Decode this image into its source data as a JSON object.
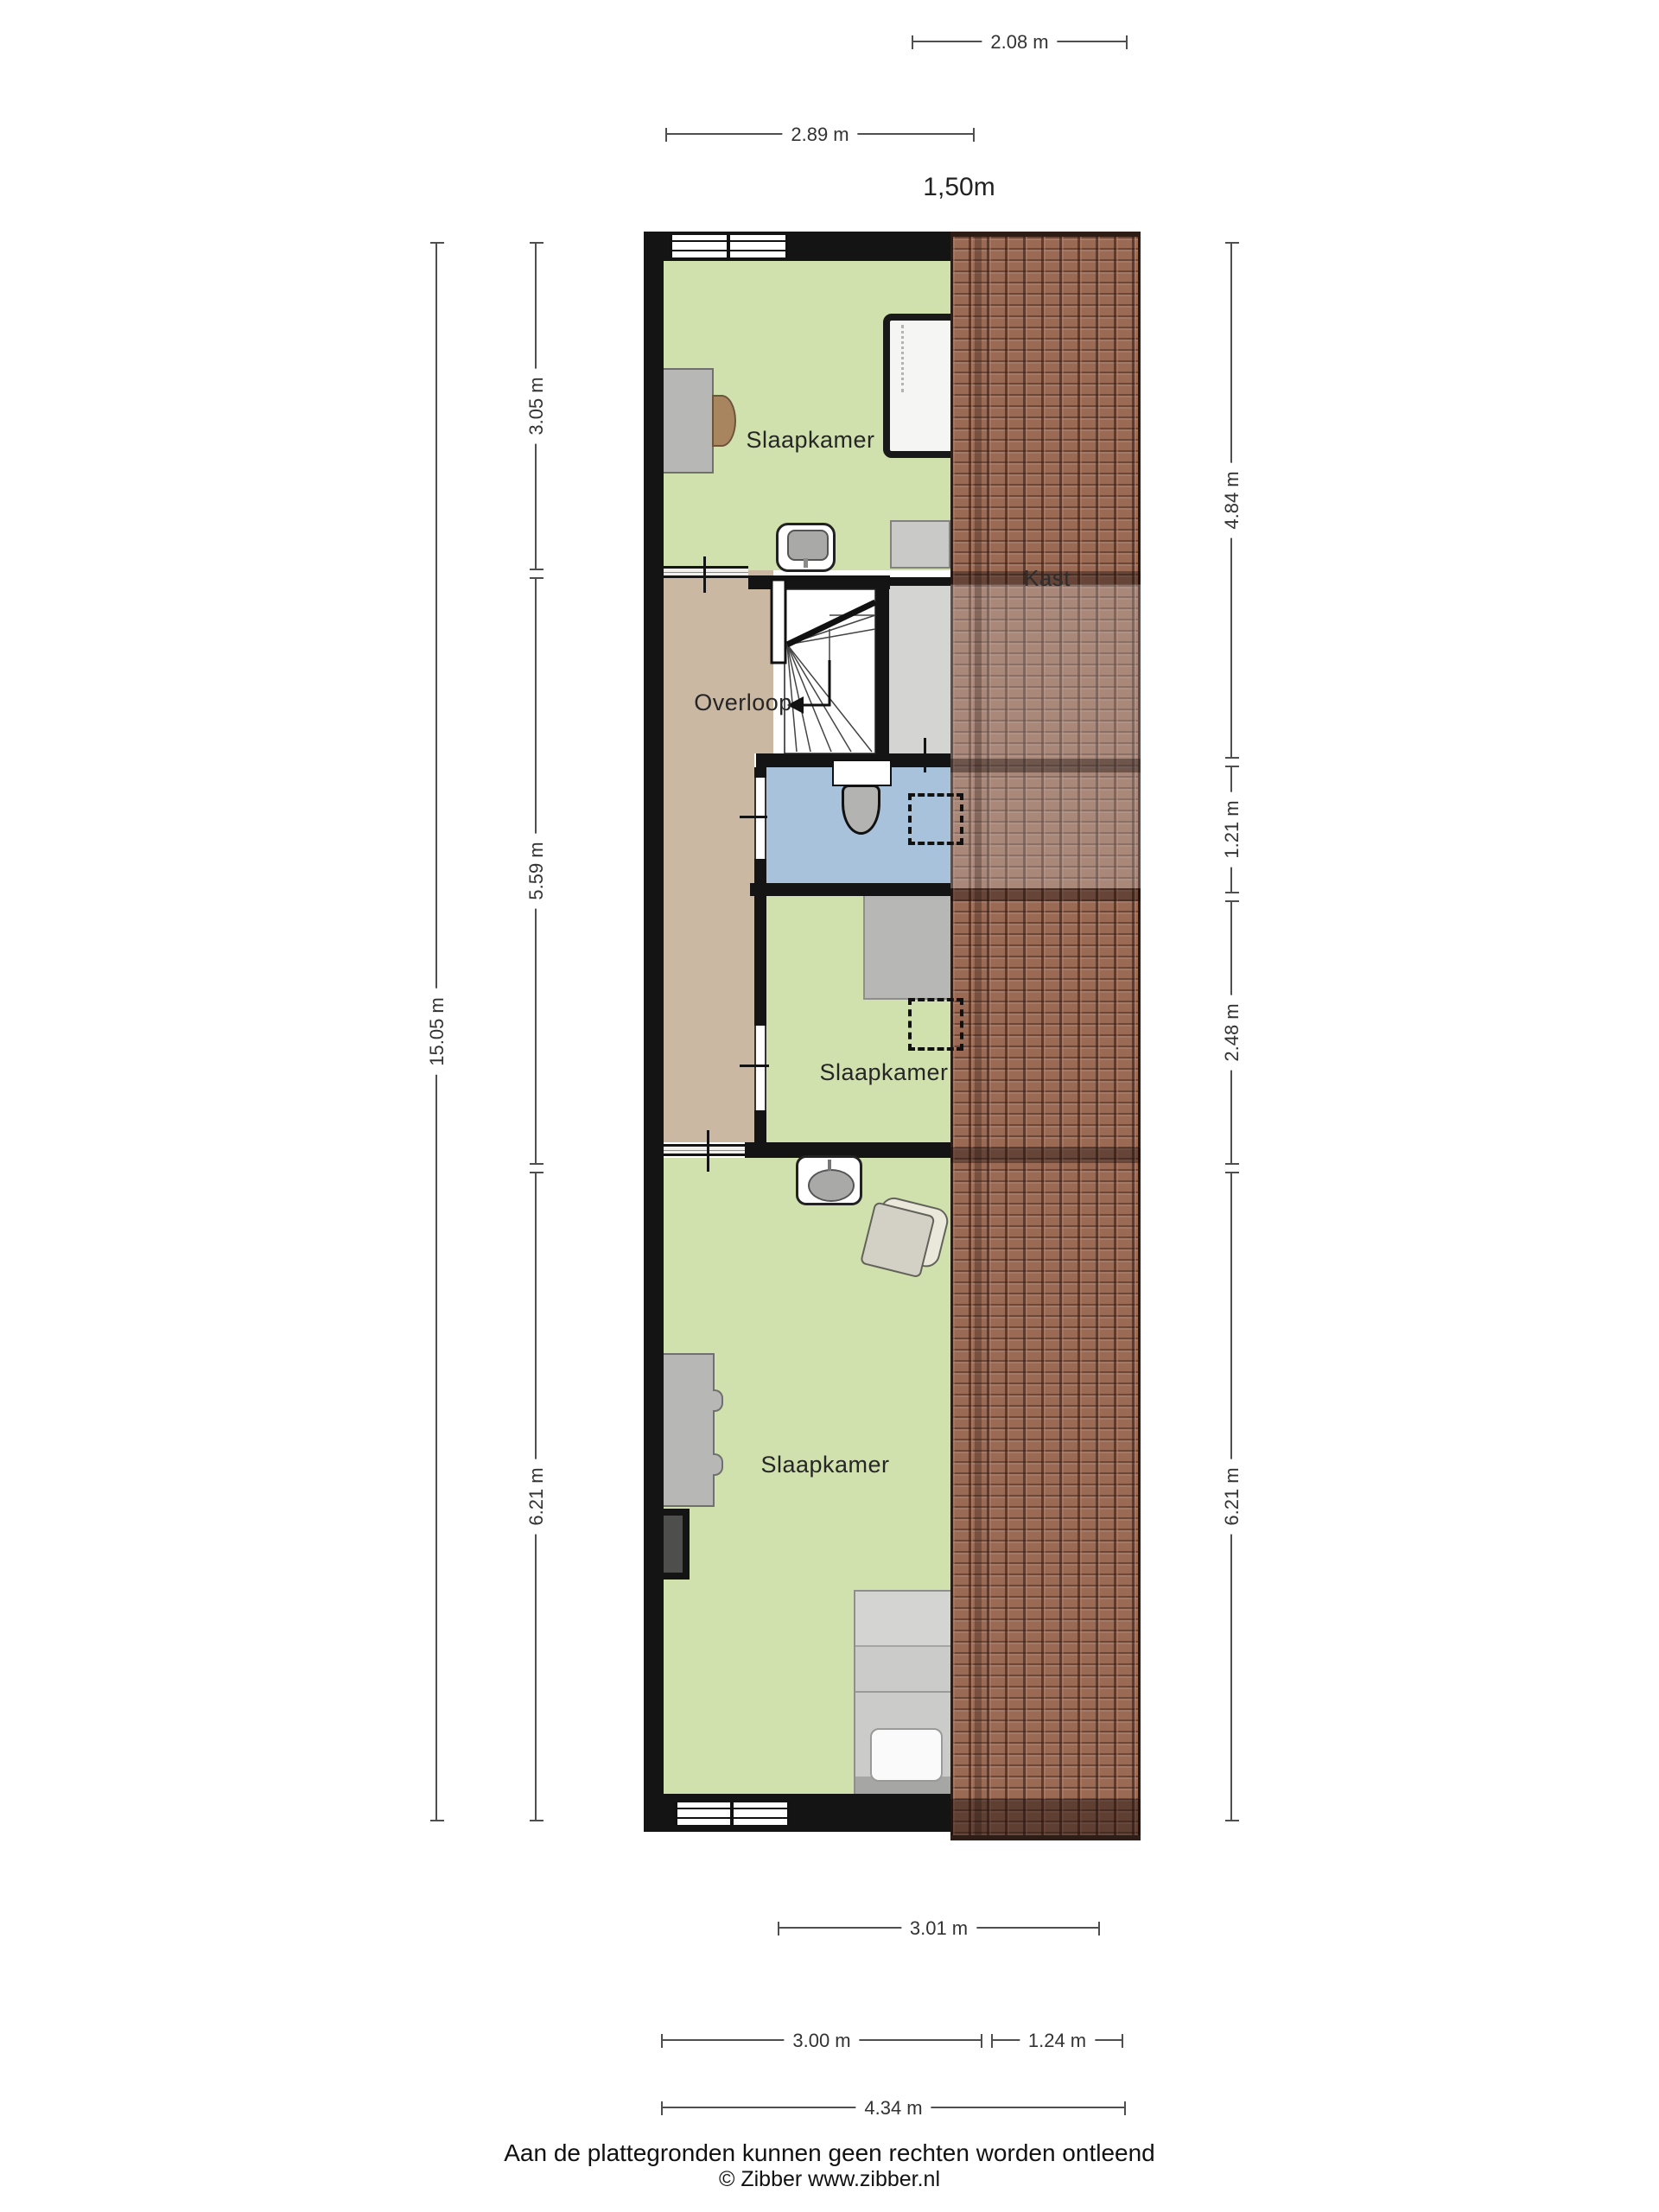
{
  "plan": {
    "scale_label": "1,50m",
    "rooms": {
      "bedroom_top": {
        "label": "Slaapkamer"
      },
      "landing": {
        "label": "Overloop"
      },
      "closet": {
        "label": "Kast"
      },
      "bedroom_middle": {
        "label": "Slaapkamer"
      },
      "bedroom_bottom": {
        "label": "Slaapkamer"
      }
    }
  },
  "dimensions": {
    "top": [
      "2.08 m",
      "2.89 m"
    ],
    "left_total": "15.05 m",
    "left_segments": [
      "3.05 m",
      "5.59 m",
      "6.21 m"
    ],
    "right_segments": [
      "4.84 m",
      "1.21 m",
      "2.48 m",
      "6.21 m"
    ],
    "bottom_inner": "3.01 m",
    "bottom_segments": [
      "3.00 m",
      "1.24 m"
    ],
    "bottom_total": "4.34 m"
  },
  "footer": {
    "disclaimer": "Aan de plattegronden kunnen geen rechten worden ontleend",
    "credit": "© Zibber www.zibber.nl"
  },
  "colors": {
    "wall": "#141414",
    "bedroom_green": "#d0e1ae",
    "landing_tan": "#cab8a3",
    "bathroom_blue": "#a8c2dc",
    "closet_grey": "#d4d4d2",
    "roof_tile": "#9a6a55",
    "furniture_grey": "#b7b7b5",
    "dimension_line": "#4f4f4f"
  }
}
